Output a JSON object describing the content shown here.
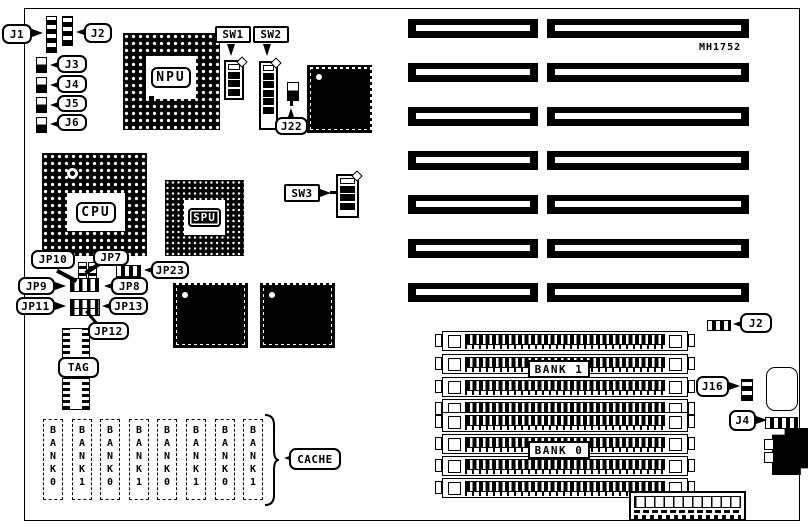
{
  "board": {
    "ref_code": "MH1752",
    "chips": {
      "npu": "NPU",
      "cpu": "CPU",
      "spu": "SPU"
    },
    "switches": {
      "sw1": "SW1",
      "sw2": "SW2",
      "sw3": "SW3"
    },
    "connectors": {
      "j1": "J1",
      "j2_top": "J2",
      "j3": "J3",
      "j4": "J4",
      "j5": "J5",
      "j6": "J6",
      "j22": "J22",
      "j2_right": "J2",
      "j16": "J16",
      "j4_right": "J4"
    },
    "jumpers": {
      "jp7": "JP7",
      "jp8": "JP8",
      "jp9": "JP9",
      "jp10": "JP10",
      "jp11": "JP11",
      "jp12": "JP12",
      "jp13": "JP13",
      "jp23": "JP23"
    },
    "memory_banks": {
      "bank1": "BANK 1",
      "bank0": "BANK 0"
    },
    "cache": {
      "label": "CACHE",
      "tag": "TAG",
      "sockets": [
        "BANK0",
        "BANK1",
        "BANK0",
        "BANK1",
        "BANK0",
        "BANK1",
        "BANK0",
        "BANK1"
      ]
    }
  }
}
